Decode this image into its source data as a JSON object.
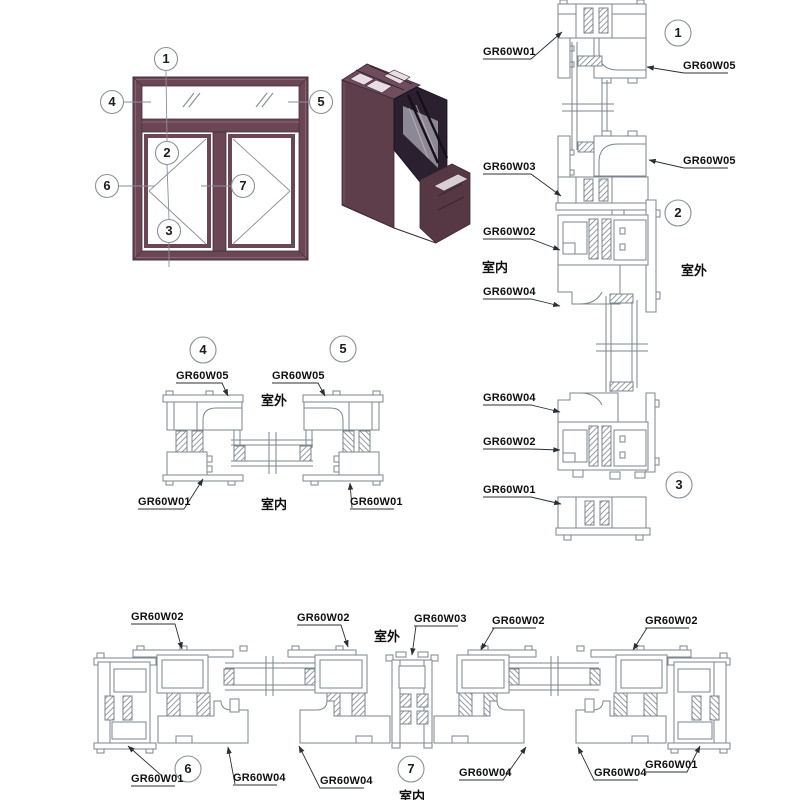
{
  "parts": {
    "w01": "GR60W01",
    "w02": "GR60W02",
    "w03": "GR60W03",
    "w04": "GR60W04",
    "w05": "GR60W05"
  },
  "rooms": {
    "indoor": "室内",
    "outdoor": "室外"
  },
  "callouts": {
    "c1": "1",
    "c2": "2",
    "c3": "3",
    "c4": "4",
    "c5": "5",
    "c6": "6",
    "c7": "7"
  },
  "colors": {
    "frame_maroon": "#6b4655",
    "line_gray": "#7d858c",
    "leader_black": "#2b2f33"
  }
}
